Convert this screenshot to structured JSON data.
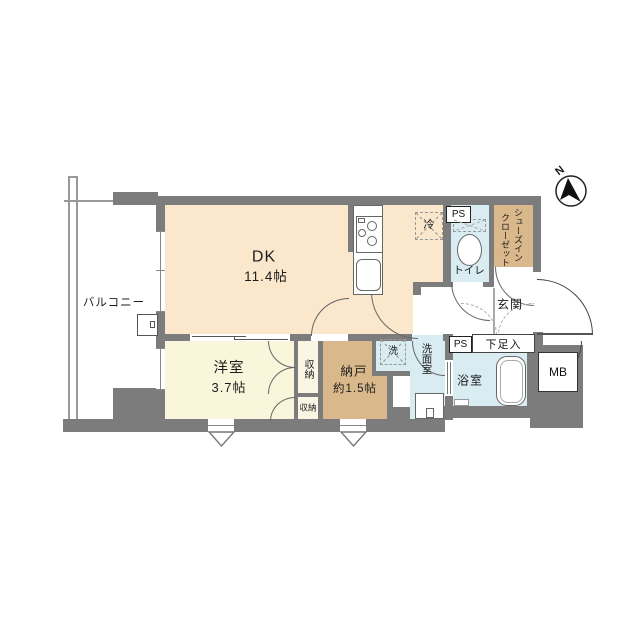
{
  "compass": {
    "n": "N"
  },
  "labels": {
    "balcony": "バルコニー",
    "dk_name": "DK",
    "dk_size": "11.4帖",
    "western_room_name": "洋室",
    "western_room_size": "3.7帖",
    "storage_room_name": "納戸",
    "storage_room_size": "約1.5帖",
    "closet_upper": "収納",
    "closet_lower": "収納",
    "refrigerator": "冷",
    "toilet": "トイレ",
    "shoes_closet_line1": "シューズイン",
    "shoes_closet_line2": "クローゼット",
    "entrance": "玄関",
    "shoe_box": "下足入",
    "ps_upper": "PS",
    "ps_lower": "PS",
    "washer": "洗",
    "washroom": "洗面室",
    "bathroom": "浴室",
    "meter_box": "MB"
  },
  "colors": {
    "wall": "#7c7c7c",
    "dk_floor": "#fbe7cb",
    "western_room_floor": "#f9f6dc",
    "storage_floor": "#d9b98c",
    "wet_area_floor": "#d8ecf2",
    "background": "#ffffff"
  }
}
